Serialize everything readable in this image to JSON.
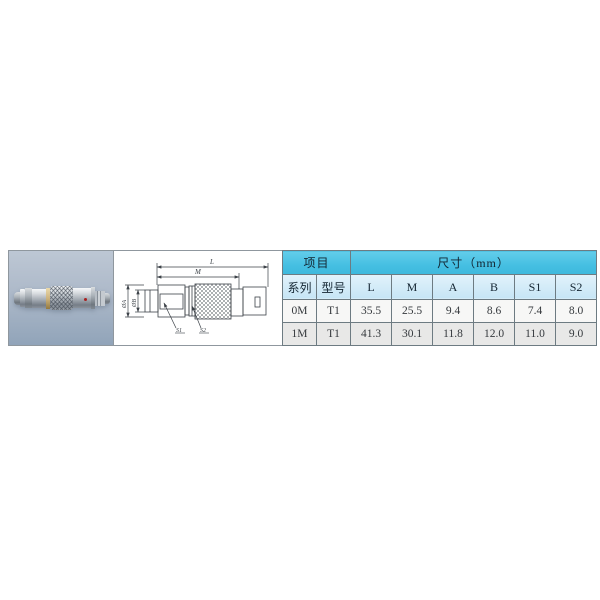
{
  "page": {
    "background": "#ffffff"
  },
  "photo": {
    "description": "metal push-pull circular connector on blue-gray background",
    "red_dot_color": "#a81f1f"
  },
  "drawing": {
    "dim_l": "L",
    "dim_m": "M",
    "dim_dia_a": "ØA",
    "dim_dia_b": "ØB",
    "leader_s1": "S1",
    "leader_s2": "S2"
  },
  "table": {
    "header_item": "项目",
    "header_dims": "尺寸（mm）",
    "columns": [
      "系列",
      "型号",
      "L",
      "M",
      "A",
      "B",
      "S1",
      "S2"
    ],
    "rows": [
      [
        "0M",
        "T1",
        "35.5",
        "25.5",
        "9.4",
        "8.6",
        "7.4",
        "8.0"
      ],
      [
        "1M",
        "T1",
        "41.3",
        "30.1",
        "11.8",
        "12.0",
        "11.0",
        "9.0"
      ]
    ]
  },
  "colors": {
    "header_cyan": "#45bfe2",
    "header_light_blue": "#c6e5f5",
    "row_light": "#f7f7f6",
    "row_gray": "#e8e8e7",
    "photo_bg_top": "#bdc7d4",
    "photo_bg_bottom": "#91a4b9",
    "line_color": "#3c4248"
  }
}
